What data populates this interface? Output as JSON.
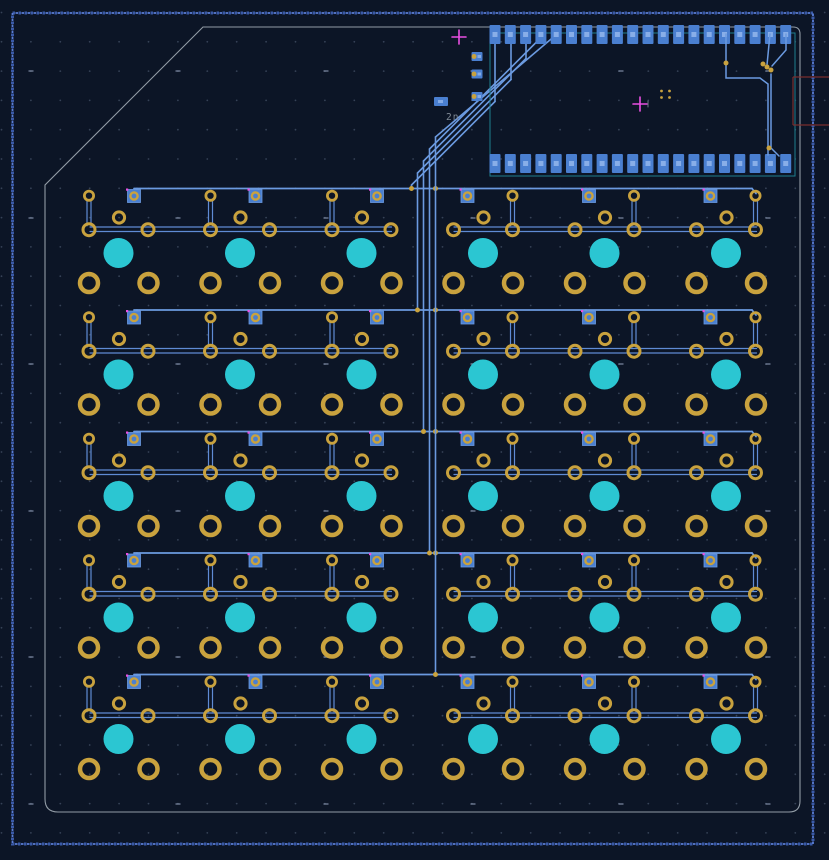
{
  "canvas": {
    "width": 829,
    "height": 860,
    "background": "#0c1526",
    "description": "PCB editor canvas showing keyboard matrix board, back-copper view"
  },
  "colors": {
    "background": "#0c1526",
    "trace": "#6b9ae0",
    "trace_thin": "#5f8bd4",
    "gold": "#c9a23e",
    "pad_blue": "#4a7fd0",
    "pad_blue_light": "#9dbdf0",
    "switch_hole_cyan": "#2bc6d2",
    "board_edge": "#9aa3ad",
    "zone_hatch": "#5b7ed6",
    "zone_hatch_dark": "#3a5aa8",
    "courtyard": "#1e7f8f",
    "fab": "#7a2e2e",
    "marker_magenta": "#ea4fe2",
    "grid_dot": "#5a6880",
    "grid_major": "#77839c",
    "ref_text": "#808a96"
  },
  "grid": {
    "pitch_x": 29.4,
    "pitch_y": 29.3,
    "origin_x": 1.5,
    "origin_y": 12.5,
    "major_x": [
      31,
      178,
      326,
      473,
      621,
      768
    ],
    "major_y": [
      71,
      218,
      364,
      511,
      657,
      804
    ]
  },
  "zone_outline": {
    "x": 12.5,
    "y": 13,
    "w": 800.5,
    "h": 831
  },
  "board_outline": {
    "top_y": 27,
    "right_x": 800,
    "bottom_y": 812,
    "left_x": 45,
    "chamfer_top_x": 203,
    "chamfer_left_y": 185,
    "corner_radius": 11
  },
  "module": {
    "ref": "2n",
    "body": {
      "x": 490,
      "y": 33,
      "w": 305,
      "h": 143
    },
    "pads": {
      "count_top": 20,
      "count_bottom": 20,
      "first_x": 495,
      "pitch": 15.3,
      "w": 11,
      "h": 19,
      "top_y": 25,
      "bottom_y": 154
    },
    "left_pads": [
      [
        477,
        56.5
      ],
      [
        477,
        74
      ],
      [
        477,
        96.5
      ]
    ],
    "wide_pad": [
      441,
      101.5
    ],
    "anchor_crosses": [
      [
        459,
        37
      ],
      [
        640,
        104
      ]
    ],
    "center_dots": [
      [
        661.5,
        91
      ],
      [
        669.5,
        91
      ],
      [
        661.5,
        97.5
      ],
      [
        669.5,
        97.5
      ]
    ],
    "usb_fab": {
      "x1": 793,
      "x2": 829,
      "y1": 77,
      "y2": 125
    },
    "right_vias": [
      [
        726,
        63
      ],
      [
        763,
        64
      ],
      [
        767,
        67
      ],
      [
        771,
        70
      ],
      [
        769,
        148
      ]
    ]
  },
  "bundle": {
    "verticals_x": [
      411.5,
      417.5,
      423.5,
      429.5,
      435.5
    ],
    "sources_x": [
      495,
      511,
      526,
      541,
      557
    ],
    "pad_bottom_y": 34,
    "turn_c": [
      596.5,
      590.5,
      584.5,
      578.5,
      572.5
    ]
  },
  "keys": {
    "cols_x": [
      118.5,
      240,
      361.5,
      483,
      604.5,
      726
    ],
    "rows_y": [
      253,
      374.5,
      496,
      617.5,
      739
    ],
    "mirrored_cols": [
      3,
      4,
      5
    ],
    "bus_dy": -64.5,
    "ring_top_dy": -57.3,
    "pad_b_dx": 15.5,
    "diode_line_dy": [
      -26,
      -21.5
    ],
    "side_dy": -23.3,
    "side_dx": 29.5,
    "mid_dx": 0.5,
    "mid_dy": -35.5,
    "switch_hole_r": 15,
    "bottom_ring_dy": 30,
    "double_left_seg": [
      90,
      391.5
    ],
    "double_right_seg": [
      454,
      756.5
    ],
    "bus_x": [
      134,
      752
    ]
  }
}
